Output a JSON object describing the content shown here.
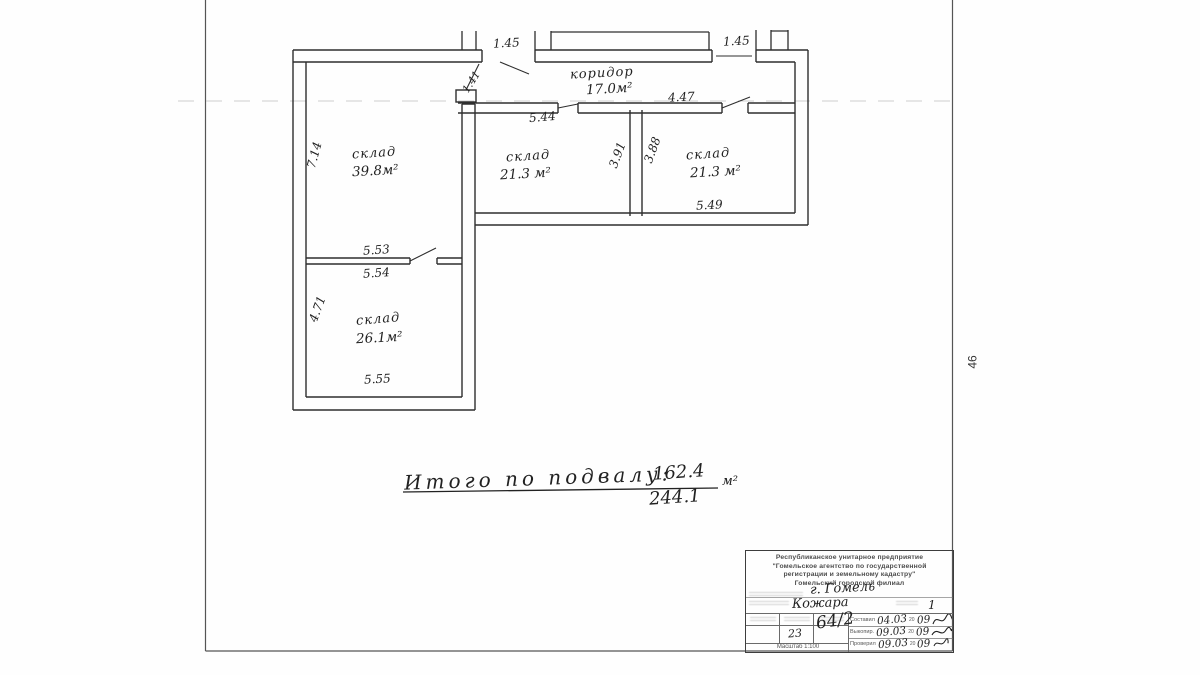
{
  "page": {
    "side_number": "46"
  },
  "plan": {
    "rooms": {
      "corridor": {
        "name": "коридор",
        "area": "17.0м²"
      },
      "sklad1": {
        "name": "склад",
        "area": "39.8м²"
      },
      "sklad2": {
        "name": "склад",
        "area": "21.3 м²"
      },
      "sklad3": {
        "name": "склад",
        "area": "21.3 м²"
      },
      "sklad4": {
        "name": "склад",
        "area": "26.1м²"
      }
    },
    "dims": {
      "top_left": "1.45",
      "top_right": "1.45",
      "door_left": "1.41",
      "corr_right": "4.47",
      "mid_top": "5.44",
      "left_wing_h": "7.14",
      "mid_right_h": "3.91",
      "right_left_h": "3.88",
      "right_bottom": "5.49",
      "part_top": "5.53",
      "part_bottom": "5.54",
      "low_left_h": "4.71",
      "low_bottom": "5.55"
    },
    "total": {
      "label": "Итого по подвалу:",
      "numerator": "162.4",
      "denominator": "244.1",
      "unit": "м²"
    }
  },
  "title_block": {
    "org_line1": "Республиканское унитарное предприятие",
    "org_line2": "\"Гомельское агентство по государственной",
    "org_line3": "регистрации и земельному кадастру\"",
    "org_line4": "Гомельский городской филиал",
    "city": "г. Гомель",
    "street": "Кожара",
    "house": "1",
    "sheet_no": "23",
    "inv_no": "64/2",
    "year_prefix": "20",
    "rows": [
      {
        "label": "Составил",
        "date": "04.03",
        "year": "09"
      },
      {
        "label": "Выкопир.",
        "date": "09.03",
        "year": "09"
      },
      {
        "label": "Проверил",
        "date": "09.03",
        "year": "09"
      }
    ],
    "scale": "Масштаб 1:100"
  }
}
